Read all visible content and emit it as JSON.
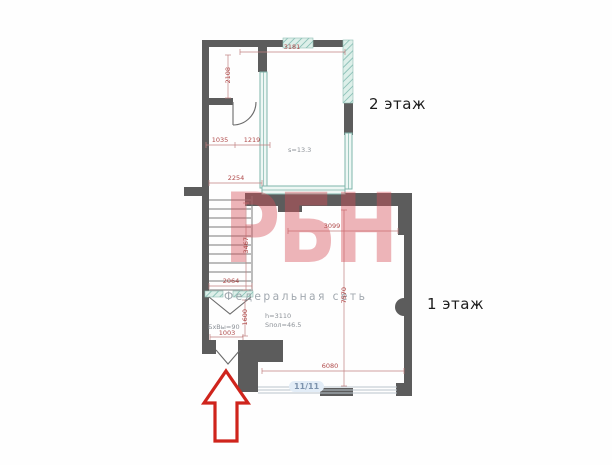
{
  "watermark": {
    "logo": "РБН",
    "subtitle": "Федеральная сеть"
  },
  "floor_labels": {
    "second_floor": "2 этаж",
    "first_floor": "1 этаж"
  },
  "entrance_badge": "11/11",
  "annotations": {
    "room2f_area": "s=13.3",
    "hall_height": "h=3110",
    "hall_area": "Sпол=46.5",
    "door_size_note": "БхВы=90"
  },
  "dimensions": {
    "top_width": "3181",
    "upper_left_room_height": "2108",
    "wc_width": "1035",
    "wc_opening": "1219",
    "corridor_width": "2254",
    "stair_flight_length": "3467",
    "stair_width": "2064",
    "vestibule_depth": "1600",
    "entrance_opening": "1003",
    "hall_top_width": "3099",
    "hall_depth": "7570",
    "hall_bottom_width": "6080"
  },
  "colors": {
    "wall": "#5c5c5c",
    "window_glass": "#7fb5ab",
    "dimension_lines": "#b04a4a",
    "arrow": "#cf241c",
    "watermark_logo": "#d64e58",
    "watermark_subtitle": "#8a929b",
    "badge_background": "#e3edf7"
  }
}
